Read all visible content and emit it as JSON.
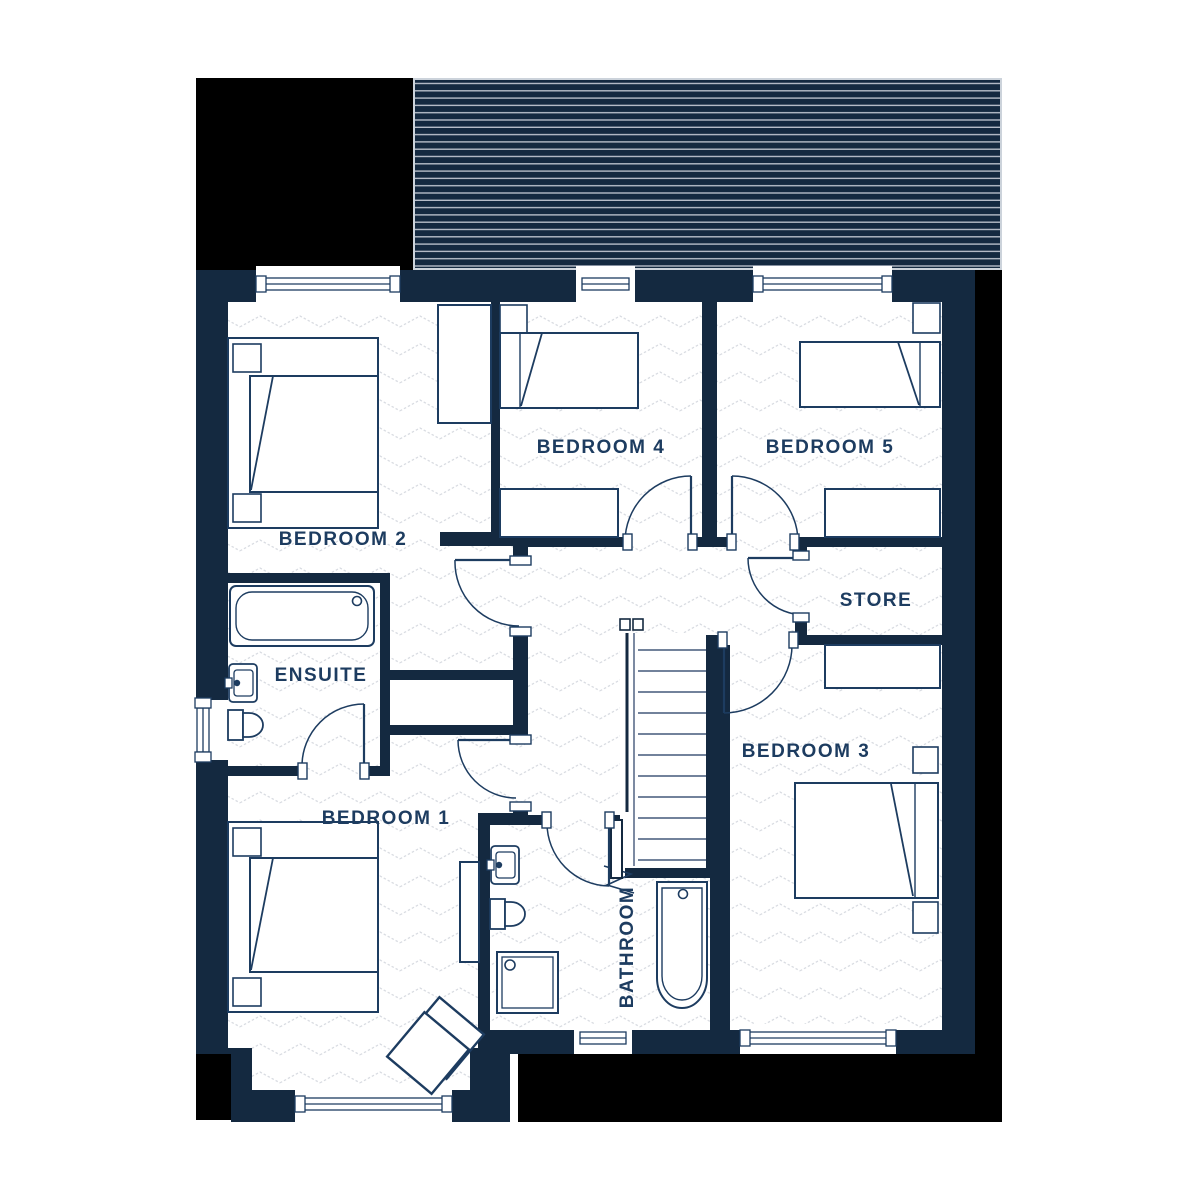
{
  "plan": {
    "floor_name": "",
    "rooms": {
      "bedroom1": {
        "label": "BEDROOM 1"
      },
      "bedroom2": {
        "label": "BEDROOM 2"
      },
      "bedroom3": {
        "label": "BEDROOM 3"
      },
      "bedroom4": {
        "label": "BEDROOM 4"
      },
      "bedroom5": {
        "label": "BEDROOM 5"
      },
      "ensuite": {
        "label": "ENSUITE"
      },
      "bathroom": {
        "label": "BATHROOM"
      },
      "store": {
        "label": "STORE"
      }
    },
    "colors": {
      "wall_navy": "#142940",
      "label_navy": "#1d3c60",
      "masked_black": "#000000",
      "floor_pattern_line": "#d9dce2",
      "roof_hatch_line": "#b6bdc8",
      "floor_white": "#ffffff"
    }
  }
}
